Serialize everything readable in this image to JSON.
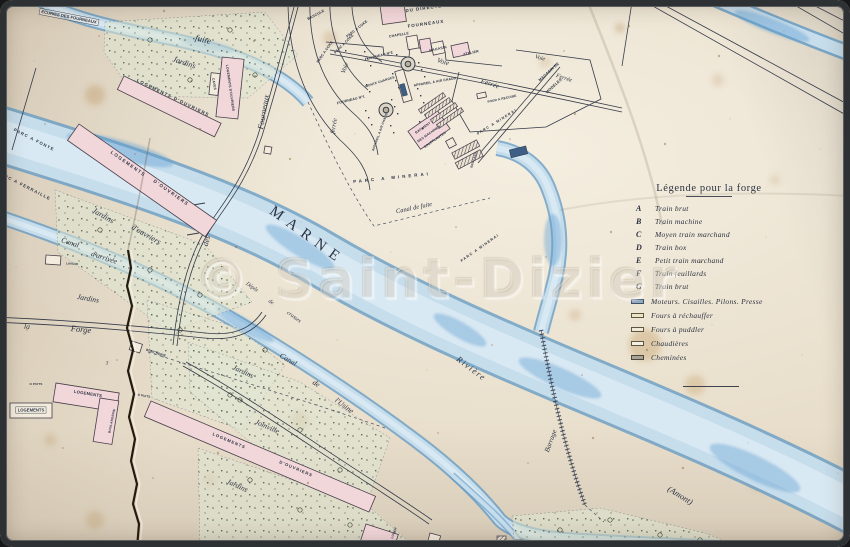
{
  "watermark": {
    "text": "© Saint-Dizier"
  },
  "legend": {
    "title": "Légende pour la forge",
    "letters": [
      {
        "key": "A",
        "label": "Train brut"
      },
      {
        "key": "B",
        "label": "Train machine"
      },
      {
        "key": "C",
        "label": "Moyen train marchand"
      },
      {
        "key": "D",
        "label": "Train box"
      },
      {
        "key": "E",
        "label": "Petit train marchand"
      },
      {
        "key": "F",
        "label": "Train feuillards"
      },
      {
        "key": "G",
        "label": "Train brut"
      }
    ],
    "swatches": [
      {
        "color": "#8fa9c0",
        "border": "#43506a",
        "label": "Moteurs. Cisailles. Pilons. Presse"
      },
      {
        "color": "#ece4c2",
        "border": "#5d5542",
        "label": "Fours à réchauffer"
      },
      {
        "color": "#f1ead9",
        "border": "#5d5542",
        "label": "Fours à puddler"
      },
      {
        "color": "#f5efe3",
        "border": "#5d5542",
        "label": "Chaudières"
      },
      {
        "color": "#a9a396",
        "border": "#4d483f",
        "label": "Cheminées"
      }
    ]
  },
  "map_labels": [
    {
      "n": "ecuries-des-fourneaux",
      "t": "ECURIES DES FOURNEAUX",
      "x": 69,
      "y": 17,
      "r": 11,
      "s": 4.2,
      "c": "boxed"
    },
    {
      "n": "canal-fuite-word",
      "t": "fuite",
      "x": 203,
      "y": 40,
      "r": 14,
      "s": 9,
      "c": "script"
    },
    {
      "n": "jardins-1",
      "t": "Jardins",
      "x": 184,
      "y": 63,
      "r": 18,
      "s": 8,
      "c": "script"
    },
    {
      "n": "logements-ouvriers-1",
      "t": "LOGEMENTS D'OUVRIERS",
      "x": 173,
      "y": 98,
      "r": 26,
      "s": 4.4,
      "ls": 1.2,
      "c": "caps"
    },
    {
      "n": "caves",
      "t": "CAVES",
      "x": 214,
      "y": 84,
      "r": 80,
      "s": 3.4,
      "c": "caps"
    },
    {
      "n": "logements-ouvriers-2",
      "t": "LOGEMENTS D'OUVRIERS",
      "x": 230,
      "y": 88,
      "r": 82,
      "s": 3.4,
      "c": "caps"
    },
    {
      "n": "rue-fourneaux",
      "t": "Fourneaux",
      "x": 264,
      "y": 112,
      "r": -80,
      "s": 8,
      "c": "script"
    },
    {
      "n": "rue-des",
      "t": "des",
      "x": 207,
      "y": 241,
      "r": -75,
      "s": 8,
      "c": "script"
    },
    {
      "n": "bascule",
      "t": "BASCULE",
      "x": 316,
      "y": 15,
      "r": -28,
      "s": 3.6,
      "c": "caps"
    },
    {
      "n": "parc-a-coke-1",
      "t": "PARC A COKE",
      "x": 357,
      "y": 29,
      "r": -38,
      "s": 3.5,
      "c": "caps"
    },
    {
      "n": "parc-a-coke-2",
      "t": "PARC A COKE",
      "x": 344,
      "y": 44,
      "r": -45,
      "s": 3.5,
      "c": "caps"
    },
    {
      "n": "parc-a-coke-3",
      "t": "PARC A COKE",
      "x": 325,
      "y": 52,
      "r": -55,
      "s": 3.5,
      "c": "caps"
    },
    {
      "n": "voie-curve",
      "t": "Voie",
      "x": 345,
      "y": 68,
      "r": -70,
      "s": 6.5,
      "c": "script"
    },
    {
      "n": "ferree-curve",
      "t": "ferrée",
      "x": 334,
      "y": 126,
      "r": -80,
      "s": 6.5,
      "c": "script"
    },
    {
      "n": "fourneau-no2",
      "t": "FOURNEAU Nº2",
      "x": 379,
      "y": 56,
      "r": -14,
      "s": 3.5,
      "c": "caps"
    },
    {
      "n": "monte-charges",
      "t": "MONTE CHARGES",
      "x": 380,
      "y": 82,
      "r": -18,
      "s": 3.2,
      "c": "caps"
    },
    {
      "n": "fourneau-no1",
      "t": "FOURNEAU Nº1",
      "x": 351,
      "y": 100,
      "r": -14,
      "s": 3.5,
      "c": "caps"
    },
    {
      "n": "appareil-air-chaud-1",
      "t": "APPAREIL A AIR CHAUD",
      "x": 435,
      "y": 82,
      "r": -10,
      "s": 3.4,
      "c": "caps"
    },
    {
      "n": "appareil-air-chaud-2",
      "t": "APPAREIL A AIR CHAUD",
      "x": 380,
      "y": 132,
      "r": -70,
      "s": 3.2,
      "c": "caps"
    },
    {
      "n": "batiment",
      "t": "BATIMENT",
      "x": 423,
      "y": 128,
      "r": -35,
      "s": 3.3,
      "c": "caps"
    },
    {
      "n": "des-machines",
      "t": "DES MACHINES",
      "x": 429,
      "y": 134,
      "r": -35,
      "s": 3.3,
      "c": "caps"
    },
    {
      "n": "soufflantes",
      "t": "SOUFFLANTES",
      "x": 435,
      "y": 140,
      "r": -35,
      "s": 3.3,
      "c": "caps"
    },
    {
      "n": "du-directeur",
      "t": "DU DIRECTEUR",
      "x": 428,
      "y": 8,
      "r": -8,
      "s": 4.4,
      "ls": 1,
      "c": "caps"
    },
    {
      "n": "fourneaux-caption",
      "t": "FOURNEAUX",
      "x": 426,
      "y": 24,
      "r": -8,
      "s": 4.4,
      "ls": 1,
      "c": "caps"
    },
    {
      "n": "chapelle",
      "t": "CHAPELLE",
      "x": 399,
      "y": 35,
      "r": -10,
      "s": 3.5,
      "c": "caps"
    },
    {
      "n": "magasin",
      "t": "MAGASIN",
      "x": 438,
      "y": 49,
      "r": -12,
      "s": 3.5,
      "c": "caps"
    },
    {
      "n": "atelier",
      "t": "ATELIER",
      "x": 471,
      "y": 53,
      "r": -12,
      "s": 3.5,
      "c": "caps"
    },
    {
      "n": "voie-1",
      "t": "Voie",
      "x": 443,
      "y": 62,
      "r": 16,
      "s": 7,
      "c": "script"
    },
    {
      "n": "ferree-1",
      "t": "Ferrée",
      "x": 490,
      "y": 84,
      "r": 18,
      "s": 7,
      "c": "script"
    },
    {
      "n": "voie-2",
      "t": "Voie",
      "x": 540,
      "y": 58,
      "r": 16,
      "s": 6,
      "c": "script"
    },
    {
      "n": "ferree-2",
      "t": "Ferrée",
      "x": 564,
      "y": 78,
      "r": 18,
      "s": 6,
      "c": "script"
    },
    {
      "n": "magasin-de",
      "t": "MAGASIN DE",
      "x": 549,
      "y": 72,
      "r": -42,
      "s": 3.8,
      "c": "caps"
    },
    {
      "n": "modeles",
      "t": "MODELES",
      "x": 554,
      "y": 86,
      "r": -42,
      "s": 3.8,
      "c": "caps"
    },
    {
      "n": "four-a-recuire",
      "t": "FOUR A RECUIRE",
      "x": 502,
      "y": 99,
      "r": -12,
      "s": 3.2,
      "c": "caps"
    },
    {
      "n": "parc-minerai-1",
      "t": "PARC A MINERAI",
      "x": 497,
      "y": 122,
      "r": -32,
      "s": 3.6,
      "ls": 1.2,
      "c": "caps"
    },
    {
      "n": "parc-minerai-2",
      "t": "PARC A MINERAI",
      "x": 392,
      "y": 178,
      "r": -6,
      "s": 4.4,
      "ls": 3,
      "c": "caps"
    },
    {
      "n": "canal-de-fuite",
      "t": "Canal de fuite",
      "x": 414,
      "y": 208,
      "r": -12,
      "s": 6.5,
      "c": "script"
    },
    {
      "n": "parc-minerai-3",
      "t": "PARC A MINERAI",
      "x": 480,
      "y": 248,
      "r": -35,
      "s": 3.6,
      "ls": 1.2,
      "c": "caps"
    },
    {
      "n": "brocard",
      "t": "BROCARD",
      "x": 474,
      "y": 160,
      "r": -72,
      "s": 3,
      "c": "caps"
    },
    {
      "n": "marne-river-name",
      "t": "MARNE",
      "x": 307,
      "y": 236,
      "r": 36,
      "s": 15,
      "ls": 7,
      "c": "river"
    },
    {
      "n": "depot",
      "t": "Dépôt",
      "x": 252,
      "y": 287,
      "r": 36,
      "s": 5.5,
      "c": "script"
    },
    {
      "n": "depot-de",
      "t": "de",
      "x": 271,
      "y": 302,
      "r": 36,
      "s": 5.5,
      "c": "script"
    },
    {
      "n": "crasses",
      "t": "crasses",
      "x": 294,
      "y": 317,
      "r": 36,
      "s": 5.5,
      "c": "script"
    },
    {
      "n": "canal-arrivee-1",
      "t": "Canal",
      "x": 70,
      "y": 243,
      "r": 18,
      "s": 7.5,
      "c": "script"
    },
    {
      "n": "canal-arrivee-2",
      "t": "d'arrivée",
      "x": 104,
      "y": 258,
      "r": 18,
      "s": 7.5,
      "c": "script"
    },
    {
      "n": "lavoir",
      "t": "LAVOIR",
      "x": 72,
      "y": 264,
      "r": 4,
      "s": 3,
      "c": "caps"
    },
    {
      "n": "jardins-ouvriers-1",
      "t": "Jardins",
      "x": 103,
      "y": 216,
      "r": 30,
      "s": 8,
      "c": "script"
    },
    {
      "n": "jardins-ouvriers-2",
      "t": "d'ouvriers",
      "x": 146,
      "y": 235,
      "r": 30,
      "s": 8,
      "c": "script"
    },
    {
      "n": "parc-a-fonte",
      "t": "PARC A FONTE",
      "x": 34,
      "y": 140,
      "r": 27,
      "s": 4.2,
      "ls": 1.2,
      "c": "caps"
    },
    {
      "n": "parc-a-ferraille",
      "t": "PARC A FERRAILLE",
      "x": 24,
      "y": 186,
      "r": 27,
      "s": 4.2,
      "ls": 1.2,
      "c": "caps"
    },
    {
      "n": "logements-ouvriers-3a",
      "t": "LOGEMENTS",
      "x": 128,
      "y": 164,
      "r": 35,
      "s": 4.6,
      "ls": 1.4,
      "c": "caps"
    },
    {
      "n": "logements-ouvriers-3b",
      "t": "D'OUVRIERS",
      "x": 171,
      "y": 193,
      "r": 35,
      "s": 4.6,
      "ls": 1.4,
      "c": "caps"
    },
    {
      "n": "la",
      "t": "la",
      "x": 27,
      "y": 327,
      "r": 5,
      "s": 7.5,
      "c": "script"
    },
    {
      "n": "forge",
      "t": "Forge",
      "x": 81,
      "y": 330,
      "r": 6,
      "s": 8.5,
      "c": "script"
    },
    {
      "n": "boucherie",
      "t": "BOUCHERIE",
      "x": 156,
      "y": 353,
      "r": 18,
      "s": 3.2,
      "c": "caps"
    },
    {
      "n": "puits-1",
      "t": "O PUITS",
      "x": 36,
      "y": 384,
      "r": 0,
      "s": 3,
      "c": "caps"
    },
    {
      "n": "puits-2",
      "t": "O PUITS",
      "x": 144,
      "y": 396,
      "r": 10,
      "s": 3,
      "c": "caps"
    },
    {
      "n": "logements-1",
      "t": "LOGEMENTS",
      "x": 88,
      "y": 394,
      "r": 9,
      "s": 4.2,
      "c": "caps"
    },
    {
      "n": "boulangerie",
      "t": "BOULANGERIE",
      "x": 112,
      "y": 421,
      "r": -78,
      "s": 3.1,
      "c": "caps"
    },
    {
      "n": "logements-2",
      "t": "LOGEMENTS",
      "x": 31,
      "y": 410,
      "r": 0,
      "s": 4.2,
      "c": "boxed"
    },
    {
      "n": "jardins-2",
      "t": "Jardins",
      "x": 88,
      "y": 299,
      "r": 10,
      "s": 7.5,
      "c": "script"
    },
    {
      "n": "jardins-3",
      "t": "Jardins",
      "x": 243,
      "y": 372,
      "r": 25,
      "s": 7.5,
      "c": "script"
    },
    {
      "n": "joinville",
      "t": "Joinville",
      "x": 267,
      "y": 427,
      "r": 24,
      "s": 7.5,
      "c": "script"
    },
    {
      "n": "canal-usine-1",
      "t": "Canal",
      "x": 288,
      "y": 360,
      "r": 30,
      "s": 7.5,
      "c": "script"
    },
    {
      "n": "canal-usine-2",
      "t": "de",
      "x": 316,
      "y": 384,
      "r": 33,
      "s": 7.5,
      "c": "script"
    },
    {
      "n": "canal-usine-3",
      "t": "l'Usine",
      "x": 344,
      "y": 406,
      "r": 36,
      "s": 7.5,
      "c": "script"
    },
    {
      "n": "logements-ouvriers-4a",
      "t": "LOGEMENTS",
      "x": 229,
      "y": 441,
      "r": 23,
      "s": 4.2,
      "ls": 1,
      "c": "caps"
    },
    {
      "n": "logements-ouvriers-4b",
      "t": "D'OUVRIERS",
      "x": 296,
      "y": 469,
      "r": 23,
      "s": 4.2,
      "ls": 1,
      "c": "caps"
    },
    {
      "n": "jardins-4",
      "t": "Jardins",
      "x": 237,
      "y": 486,
      "r": 25,
      "s": 7.5,
      "c": "script"
    },
    {
      "n": "riviere",
      "t": "Rivière",
      "x": 471,
      "y": 369,
      "r": 37,
      "s": 8.5,
      "ls": 1.5,
      "c": "script"
    },
    {
      "n": "barrage",
      "t": "Barrage",
      "x": 551,
      "y": 441,
      "r": -70,
      "s": 7,
      "c": "script"
    },
    {
      "n": "amont",
      "t": "(Amont)",
      "x": 680,
      "y": 496,
      "r": 32,
      "s": 8.5,
      "c": "script"
    },
    {
      "n": "logem",
      "t": "LOGEM",
      "x": 394,
      "y": 533,
      "r": -70,
      "s": 3,
      "c": "caps"
    },
    {
      "n": "parcel-3",
      "t": "3",
      "x": 107,
      "y": 363,
      "r": 0,
      "s": 5,
      "c": "script"
    }
  ]
}
